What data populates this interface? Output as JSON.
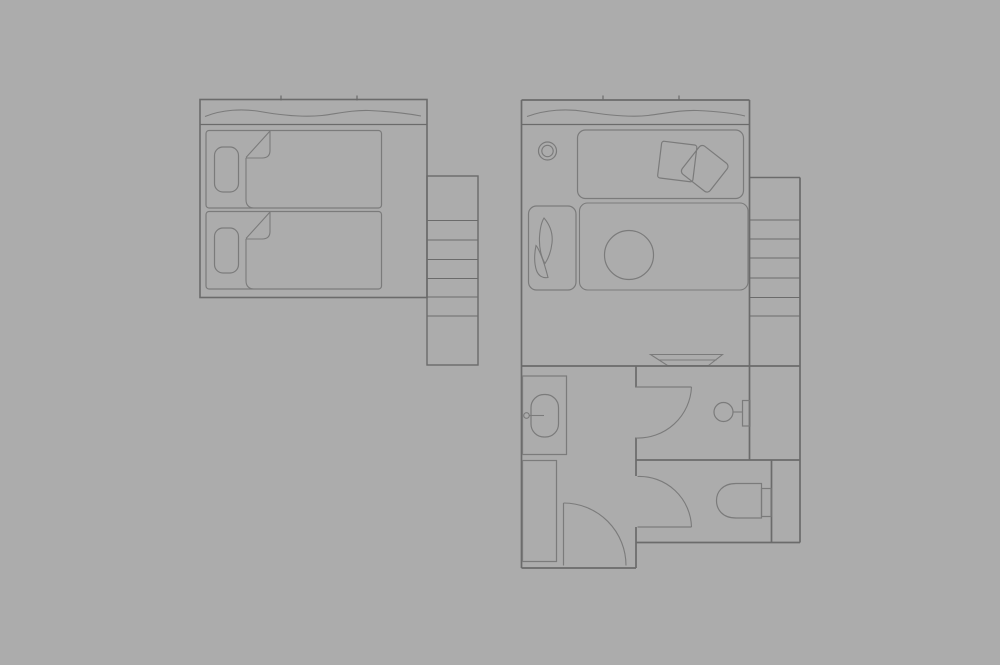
{
  "canvas": {
    "width": 1000,
    "height": 665,
    "background": "#acacac"
  },
  "colors": {
    "wall": "#6b6b6b",
    "furn": "#7b7b7b"
  },
  "elements": [
    {
      "type": "rect",
      "name": "unit-a-outline",
      "s": "wall",
      "w": 1.6,
      "x": 200,
      "y": 99.5,
      "wd": 227,
      "h": 198
    },
    {
      "type": "line",
      "name": "unit-a-window-sill",
      "s": "wall",
      "w": 1.2,
      "x1": 200,
      "y1": 124.5,
      "x2": 427,
      "y2": 124.5
    },
    {
      "type": "line",
      "name": "unit-a-window-tick-1",
      "s": "wall",
      "w": 1.2,
      "x1": 281,
      "y1": 95.5,
      "x2": 281,
      "y2": 100.5
    },
    {
      "type": "line",
      "name": "unit-a-window-tick-2",
      "s": "wall",
      "w": 1.2,
      "x1": 357,
      "y1": 95.5,
      "x2": 357,
      "y2": 100.5
    },
    {
      "type": "path",
      "name": "unit-a-curtain-wave",
      "s": "furn",
      "w": 1.1,
      "d": "M205,116.5 C222,109.5 243,108.5 260,111.5 C280,115 303,117.5 322,115.5 C338,113.5 352,110 369,110.5 C390,111.5 408,113.5 421,116"
    },
    {
      "type": "rect",
      "name": "unit-a-shelf-column",
      "s": "wall",
      "w": 1.4,
      "x": 427,
      "y": 176,
      "wd": 51,
      "h": 189
    },
    {
      "type": "line",
      "name": "unit-a-shelf-line-1",
      "s": "wall",
      "w": 1.1,
      "x1": 427,
      "y1": 220.5,
      "x2": 478,
      "y2": 220.5
    },
    {
      "type": "line",
      "name": "unit-a-shelf-line-2",
      "s": "wall",
      "w": 1.1,
      "x1": 427,
      "y1": 240,
      "x2": 478,
      "y2": 240
    },
    {
      "type": "line",
      "name": "unit-a-shelf-line-3",
      "s": "wall",
      "w": 1.1,
      "x1": 427,
      "y1": 259.5,
      "x2": 478,
      "y2": 259.5
    },
    {
      "type": "line",
      "name": "unit-a-shelf-line-4",
      "s": "wall",
      "w": 1.1,
      "x1": 427,
      "y1": 278.5,
      "x2": 478,
      "y2": 278.5
    },
    {
      "type": "line",
      "name": "unit-a-shelf-line-5",
      "s": "wall",
      "w": 1.1,
      "x1": 427,
      "y1": 297,
      "x2": 478,
      "y2": 297
    },
    {
      "type": "line",
      "name": "unit-a-shelf-line-6",
      "s": "wall",
      "w": 1.1,
      "x1": 427,
      "y1": 316,
      "x2": 478,
      "y2": 316
    },
    {
      "type": "rect",
      "name": "bed-1",
      "s": "furn",
      "w": 1.2,
      "x": 206,
      "y": 130.5,
      "wd": 175.5,
      "h": 77.5,
      "rx": 3
    },
    {
      "type": "rect",
      "name": "bed-1-pillow",
      "s": "furn",
      "w": 1.2,
      "x": 214.5,
      "y": 147,
      "wd": 24,
      "h": 45,
      "rx": 8.5
    },
    {
      "type": "path",
      "name": "bed-1-blanket-fold-diagonal",
      "s": "furn",
      "w": 1.1,
      "d": "M270,131 L246,157.5"
    },
    {
      "type": "path",
      "name": "bed-1-blanket-fold-flap",
      "s": "furn",
      "w": 1.1,
      "d": "M270,131 L270,150.5 Q270,158 262,158 L246,158"
    },
    {
      "type": "path",
      "name": "bed-1-blanket-edge",
      "s": "furn",
      "w": 1.1,
      "d": "M246,158 L246,199.5 Q246,207.5 253.5,208"
    },
    {
      "type": "rect",
      "name": "bed-2",
      "s": "furn",
      "w": 1.2,
      "x": 206,
      "y": 211.5,
      "wd": 175.5,
      "h": 77.5,
      "rx": 3
    },
    {
      "type": "rect",
      "name": "bed-2-pillow",
      "s": "furn",
      "w": 1.2,
      "x": 214.5,
      "y": 228,
      "wd": 24,
      "h": 45,
      "rx": 8.5
    },
    {
      "type": "path",
      "name": "bed-2-blanket-fold-diagonal",
      "s": "furn",
      "w": 1.1,
      "d": "M270,212 L246,238.5"
    },
    {
      "type": "path",
      "name": "bed-2-blanket-fold-flap",
      "s": "furn",
      "w": 1.1,
      "d": "M270,212 L270,231.5 Q270,239 262,239 L246,239"
    },
    {
      "type": "path",
      "name": "bed-2-blanket-edge",
      "s": "furn",
      "w": 1.1,
      "d": "M246,239 L246,280.5 Q246,288.5 253.5,289"
    },
    {
      "type": "line",
      "name": "unit-b-left-wall",
      "s": "wall",
      "w": 1.7,
      "x1": 521.5,
      "y1": 100,
      "x2": 521.5,
      "y2": 568
    },
    {
      "type": "line",
      "name": "unit-b-top-wall",
      "s": "wall",
      "w": 1.7,
      "x1": 521.5,
      "y1": 100,
      "x2": 749.5,
      "y2": 100
    },
    {
      "type": "line",
      "name": "unit-b-right-wall",
      "s": "wall",
      "w": 1.7,
      "x1": 749.5,
      "y1": 100,
      "x2": 749.5,
      "y2": 460
    },
    {
      "type": "line",
      "name": "unit-b-window-sill",
      "s": "wall",
      "w": 1.2,
      "x1": 521.5,
      "y1": 124.5,
      "x2": 749.5,
      "y2": 124.5
    },
    {
      "type": "line",
      "name": "unit-b-window-tick-1",
      "s": "wall",
      "w": 1.2,
      "x1": 603,
      "y1": 95.5,
      "x2": 603,
      "y2": 100.5
    },
    {
      "type": "line",
      "name": "unit-b-window-tick-2",
      "s": "wall",
      "w": 1.2,
      "x1": 679,
      "y1": 95.5,
      "x2": 679,
      "y2": 100.5
    },
    {
      "type": "path",
      "name": "unit-b-curtain-wave",
      "s": "furn",
      "w": 1.1,
      "d": "M527,116.5 C546,109.5 567,108.5 585,111.5 C606,115 628,117.5 648,115.5 C665,113.5 680,110 697,110.5 C718,111.5 735,113.5 745,116"
    },
    {
      "type": "circle",
      "name": "ceiling-light-outer",
      "s": "furn",
      "w": 1.2,
      "cx": 547.5,
      "cy": 151,
      "r": 9
    },
    {
      "type": "circle",
      "name": "ceiling-light-inner",
      "s": "furn",
      "w": 1.1,
      "cx": 547.5,
      "cy": 151,
      "r": 5.7
    },
    {
      "type": "rect",
      "name": "daybed",
      "s": "furn",
      "w": 1.2,
      "x": 577.5,
      "y": 130,
      "wd": 166,
      "h": 68.5,
      "rx": 8
    },
    {
      "type": "rect",
      "name": "daybed-cushion-1",
      "s": "furn",
      "w": 1.2,
      "x": 659.5,
      "y": 143,
      "wd": 35.5,
      "h": 37,
      "rx": 2.5,
      "rot": "7 677.2 161.5"
    },
    {
      "type": "rect",
      "name": "daybed-cushion-2",
      "s": "furn",
      "w": 1.2,
      "x": 687,
      "y": 151,
      "wd": 35.5,
      "h": 35.5,
      "rx": 4,
      "rot": "38 704.7 168.7"
    },
    {
      "type": "rect",
      "name": "rug-area",
      "s": "furn",
      "w": 1.1,
      "x": 579.5,
      "y": 203,
      "wd": 168.5,
      "h": 87,
      "rx": 8
    },
    {
      "type": "rect",
      "name": "wardrobe",
      "s": "furn",
      "w": 1.2,
      "x": 528.5,
      "y": 206,
      "wd": 47.5,
      "h": 84,
      "rx": 8
    },
    {
      "type": "path",
      "name": "wardrobe-leaf-1",
      "s": "furn",
      "w": 1.1,
      "d": "M544,218 C550,225 553,234 552,243 C551,252 548,259 545,263.5 C541,257 539,247 539.5,237 C540,229 541.5,222 544,218 Z"
    },
    {
      "type": "path",
      "name": "wardrobe-leaf-2",
      "s": "furn",
      "w": 1.1,
      "d": "M536,245.5 C534.5,253 534,263 536.5,270.5 C538.5,276 543,278.5 548,277.5 C546,269.5 542.5,257.5 538.5,249.5 C537.5,247.5 536.8,246.2 536,245.5 Z"
    },
    {
      "type": "circle",
      "name": "round-table",
      "s": "furn",
      "w": 1.2,
      "cx": 629,
      "cy": 255,
      "r": 24.5
    },
    {
      "type": "path",
      "name": "basin-dish",
      "s": "furn",
      "w": 1.1,
      "d": "M650.5,354.5 L722.5,354.5 L708.5,365.5 L667.5,365.5 Z"
    },
    {
      "type": "line",
      "name": "basin-dish-rim",
      "s": "furn",
      "w": 1.1,
      "x1": 658.5,
      "y1": 360,
      "x2": 716.5,
      "y2": 360
    },
    {
      "type": "line",
      "name": "unit-b-mid-wall",
      "s": "wall",
      "w": 1.7,
      "x1": 521.5,
      "y1": 366,
      "x2": 800,
      "y2": 366
    },
    {
      "type": "line",
      "name": "bath-wall-seg-1",
      "s": "wall",
      "w": 1.7,
      "x1": 636,
      "y1": 366,
      "x2": 636,
      "y2": 387.5
    },
    {
      "type": "line",
      "name": "bath-wall-seg-2",
      "s": "wall",
      "w": 1.7,
      "x1": 636,
      "y1": 437.5,
      "x2": 636,
      "y2": 476
    },
    {
      "type": "line",
      "name": "bath-wall-seg-3",
      "s": "wall",
      "w": 1.7,
      "x1": 636,
      "y1": 527,
      "x2": 636,
      "y2": 568
    },
    {
      "type": "line",
      "name": "unit-b-bottom-wall-left",
      "s": "wall",
      "w": 1.7,
      "x1": 521.5,
      "y1": 568,
      "x2": 636,
      "y2": 568
    },
    {
      "type": "line",
      "name": "lower-cross-wall",
      "s": "wall",
      "w": 1.7,
      "x1": 636,
      "y1": 460,
      "x2": 800,
      "y2": 460
    },
    {
      "type": "line",
      "name": "wc-right-wall",
      "s": "wall",
      "w": 1.7,
      "x1": 771.5,
      "y1": 460,
      "x2": 771.5,
      "y2": 542.5
    },
    {
      "type": "line",
      "name": "unit-b-bottom-wall-right",
      "s": "wall",
      "w": 1.7,
      "x1": 636,
      "y1": 542.5,
      "x2": 800,
      "y2": 542.5
    },
    {
      "type": "line",
      "name": "unit-b-outer-right-wall",
      "s": "wall",
      "w": 1.7,
      "x1": 800,
      "y1": 177.5,
      "x2": 800,
      "y2": 542.5
    },
    {
      "type": "line",
      "name": "unit-b-shelf-top",
      "s": "wall",
      "w": 1.4,
      "x1": 749.5,
      "y1": 177.5,
      "x2": 800,
      "y2": 177.5
    },
    {
      "type": "line",
      "name": "unit-b-shelf-line-1",
      "s": "wall",
      "w": 1.1,
      "x1": 749.5,
      "y1": 220,
      "x2": 800,
      "y2": 220
    },
    {
      "type": "line",
      "name": "unit-b-shelf-line-2",
      "s": "wall",
      "w": 1.1,
      "x1": 749.5,
      "y1": 239,
      "x2": 800,
      "y2": 239
    },
    {
      "type": "line",
      "name": "unit-b-shelf-line-3",
      "s": "wall",
      "w": 1.1,
      "x1": 749.5,
      "y1": 258,
      "x2": 800,
      "y2": 258
    },
    {
      "type": "line",
      "name": "unit-b-shelf-line-4",
      "s": "wall",
      "w": 1.1,
      "x1": 749.5,
      "y1": 278,
      "x2": 800,
      "y2": 278
    },
    {
      "type": "line",
      "name": "unit-b-shelf-line-5",
      "s": "wall",
      "w": 1.1,
      "x1": 749.5,
      "y1": 297.5,
      "x2": 800,
      "y2": 297.5
    },
    {
      "type": "line",
      "name": "unit-b-shelf-line-6",
      "s": "wall",
      "w": 1.1,
      "x1": 749.5,
      "y1": 316,
      "x2": 800,
      "y2": 316
    },
    {
      "type": "rect",
      "name": "vanity-counter",
      "s": "furn",
      "w": 1.2,
      "x": 522.5,
      "y": 376,
      "wd": 44,
      "h": 78.5
    },
    {
      "type": "rect",
      "name": "vanity-basin",
      "s": "furn",
      "w": 1.2,
      "x": 531,
      "y": 394.5,
      "wd": 27.5,
      "h": 42.5,
      "rx": 13
    },
    {
      "type": "circle",
      "name": "vanity-tap",
      "s": "furn",
      "w": 1.1,
      "cx": 526.5,
      "cy": 415.5,
      "r": 2.8
    },
    {
      "type": "line",
      "name": "vanity-tap-stem",
      "s": "furn",
      "w": 1.1,
      "x1": 529.3,
      "y1": 415.5,
      "x2": 544,
      "y2": 415.5
    },
    {
      "type": "rect",
      "name": "closet",
      "s": "furn",
      "w": 1.2,
      "x": 522.5,
      "y": 460.5,
      "wd": 34,
      "h": 101
    },
    {
      "type": "path",
      "name": "shower-door-panel",
      "s": "furn",
      "w": 1.2,
      "d": "M636,387 L691.5,387"
    },
    {
      "type": "path",
      "name": "shower-door-swing-arc",
      "s": "furn",
      "w": 1.1,
      "d": "M691.5,387 A53.5,53.5 0 0 1 636,438"
    },
    {
      "type": "circle",
      "name": "wall-fixture-head",
      "s": "furn",
      "w": 1.2,
      "cx": 723.5,
      "cy": 412,
      "r": 9.5
    },
    {
      "type": "line",
      "name": "wall-fixture-stem",
      "s": "furn",
      "w": 1.1,
      "x1": 733,
      "y1": 412,
      "x2": 742.5,
      "y2": 412
    },
    {
      "type": "rect",
      "name": "wall-fixture-plate",
      "s": "furn",
      "w": 1.2,
      "x": 742.5,
      "y": 400.5,
      "wd": 7.5,
      "h": 25.5
    },
    {
      "type": "line",
      "name": "entry-door-leaf",
      "s": "furn",
      "w": 1.2,
      "x1": 563.5,
      "y1": 503,
      "x2": 563.5,
      "y2": 565.5
    },
    {
      "type": "path",
      "name": "entry-door-swing-arc",
      "s": "furn",
      "w": 1.1,
      "d": "M563.5,503 A62.5,62.5 0 0 1 626,565.5"
    },
    {
      "type": "path",
      "name": "wc-door-panel",
      "s": "furn",
      "w": 1.2,
      "d": "M637.5,527 L691.5,527"
    },
    {
      "type": "path",
      "name": "wc-door-swing-arc",
      "s": "furn",
      "w": 1.1,
      "d": "M691.5,527 A52,52 0 0 0 637.5,476.5"
    },
    {
      "type": "path",
      "name": "toilet-bowl",
      "s": "furn",
      "w": 1.2,
      "d": "M761.5,483.5 L736,483.5 C722,483.5 716.5,492.5 716.5,500.5 C716.5,509 722,518 736,518 L761.5,518 Z"
    },
    {
      "type": "rect",
      "name": "toilet-tank",
      "s": "furn",
      "w": 1.2,
      "x": 761.5,
      "y": 488.5,
      "wd": 9.5,
      "h": 28
    }
  ]
}
